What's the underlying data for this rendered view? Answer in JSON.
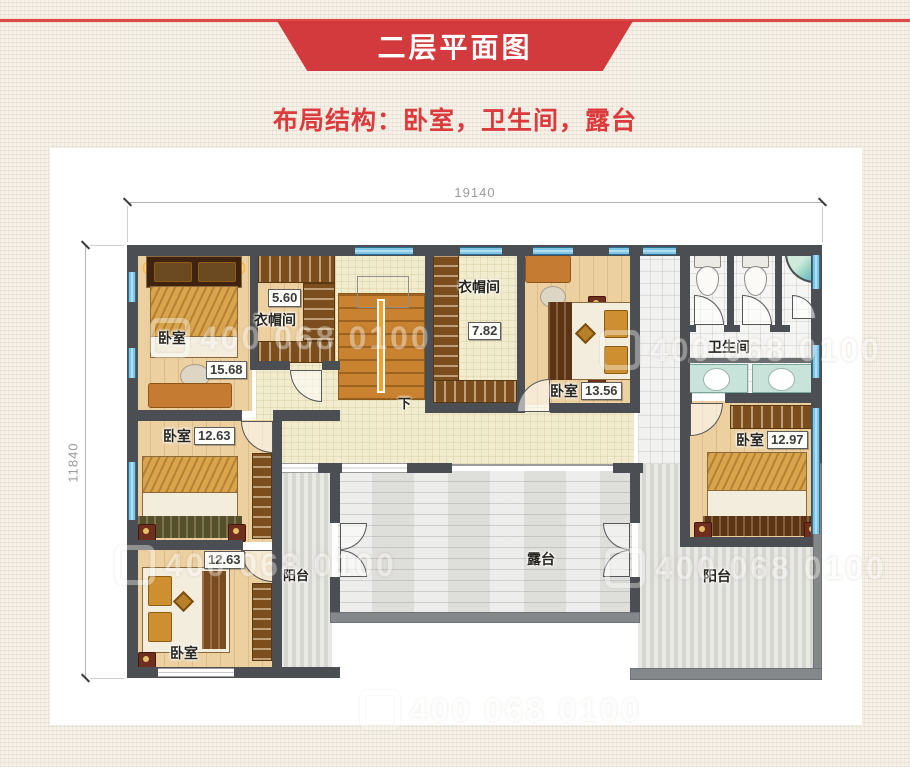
{
  "header": {
    "title": "二层平面图",
    "subtitle": "布局结构：卧室，卫生间，露台"
  },
  "dimensions": {
    "top_label": "19140",
    "left_label": "11840"
  },
  "rooms": {
    "bedroom_tl": {
      "label": "卧室",
      "area": "15.68"
    },
    "cloak_top": {
      "label": "衣帽间",
      "area": "5.60"
    },
    "cloak_mid": {
      "label": "衣帽间",
      "area": "7.82"
    },
    "bedroom_tr": {
      "label": "卧室",
      "area": "13.56"
    },
    "bathroom": {
      "label": "卫生间"
    },
    "bedroom_right": {
      "label": "卧室",
      "area": "12.97"
    },
    "bedroom_mid_left": {
      "label": "卧室",
      "area": "12.63"
    },
    "bedroom_bottom_left": {
      "label": "卧室",
      "area": "12.63"
    },
    "balcony_left": {
      "label": "阳台"
    },
    "balcony_right": {
      "label": "阳台"
    },
    "terrace": {
      "label": "露台"
    },
    "stairs": {
      "down_label": "下"
    }
  },
  "watermark": {
    "text": "400 068 0100"
  },
  "colors": {
    "banner_red": "#d23a3e",
    "subtitle_red": "#dc3b3d",
    "wall_dark": "#4b4e52",
    "wall_parapet": "#85888a",
    "window_blue": "#7ec6e4",
    "floor_wood": "#ecd0a0",
    "floor_hall": "#f2ecce"
  }
}
